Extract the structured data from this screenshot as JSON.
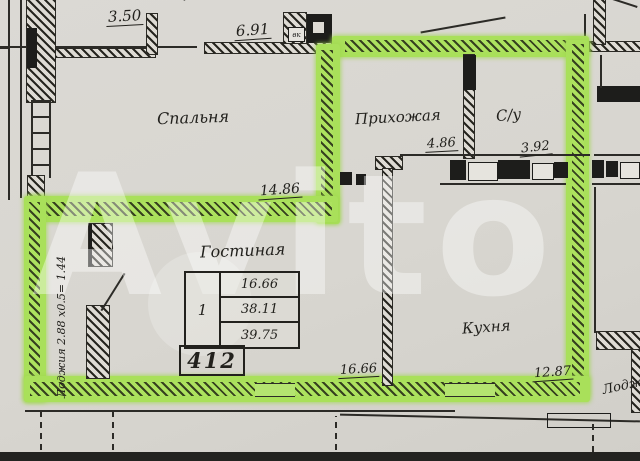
{
  "watermark": {
    "text": "Avito"
  },
  "plan": {
    "top": {
      "dim_left": "3.50",
      "dim_right": "6.91",
      "clipped_label": "Прихожая",
      "vk_label": "вк"
    },
    "rooms": {
      "bedroom": {
        "name": "Спальня",
        "dim": "14.86"
      },
      "hallway": {
        "name": "Прихожая",
        "dim": "4.86"
      },
      "bathroom": {
        "name": "С/у",
        "dim": "3.92"
      },
      "living_room": {
        "name": "Гостиная",
        "dim": "16.66"
      },
      "kitchen": {
        "name": "Кухня",
        "dim": "12.87"
      },
      "loggia_left": {
        "name": "Лоджия 2.88 х0.5= 1.44"
      },
      "loggia_right": {
        "name": "Лоджия"
      }
    },
    "stamp": {
      "room_count": "1",
      "rows": [
        "16.66",
        "38.11",
        "39.75"
      ],
      "flat_number": "412"
    }
  },
  "colors": {
    "highlight_green": "#a9e05a",
    "paper": "#d8d6d1",
    "ink": "#1d1d1b"
  }
}
